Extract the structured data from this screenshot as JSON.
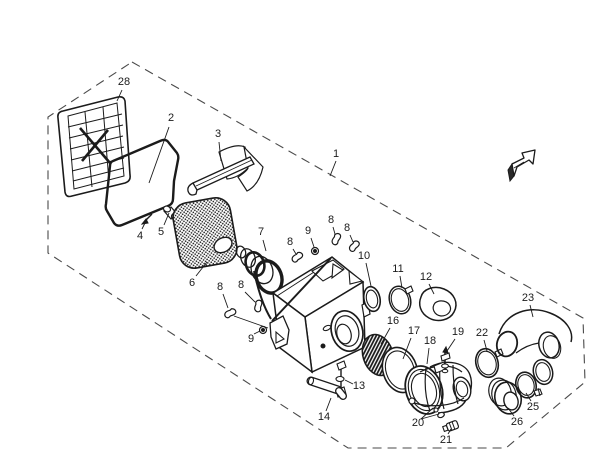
{
  "canvas": {
    "width": 605,
    "height": 471,
    "background": "#ffffff",
    "line_color": "#1b1b1b"
  },
  "diagram": {
    "type": "exploded-parts-diagram",
    "part_numbers_shown": [
      "1",
      "2",
      "3",
      "4",
      "5",
      "6",
      "7",
      "8",
      "9",
      "10",
      "11",
      "12",
      "13",
      "14",
      "16",
      "17",
      "18",
      "19",
      "20",
      "21",
      "22",
      "23",
      "25",
      "26",
      "28"
    ]
  },
  "icons": {
    "direction_arrow": "3d-arrow-up-right-icon"
  },
  "callouts": [
    {
      "n": "28",
      "x": 124,
      "y": 82,
      "leaders": [
        [
          122,
          90,
          117,
          101
        ]
      ]
    },
    {
      "n": "2",
      "x": 171,
      "y": 118,
      "leaders": [
        [
          169,
          127,
          149,
          183
        ]
      ]
    },
    {
      "n": "3",
      "x": 218,
      "y": 134,
      "leaders": [
        [
          219,
          142,
          221,
          161
        ]
      ]
    },
    {
      "n": "1",
      "x": 336,
      "y": 154,
      "leaders": [
        [
          336,
          161,
          330,
          176
        ]
      ]
    },
    {
      "n": "4",
      "x": 140,
      "y": 236,
      "leaders": [
        [
          142,
          229,
          147,
          219
        ]
      ]
    },
    {
      "n": "5",
      "x": 161,
      "y": 232,
      "leaders": [
        [
          164,
          225,
          169,
          213
        ]
      ]
    },
    {
      "n": "6",
      "x": 192,
      "y": 283,
      "leaders": [
        [
          196,
          276,
          207,
          262
        ]
      ]
    },
    {
      "n": "7",
      "x": 261,
      "y": 232,
      "leaders": [
        [
          263,
          240,
          266,
          251
        ]
      ]
    },
    {
      "n": "8",
      "x": 290,
      "y": 242,
      "leaders": [
        [
          293,
          249,
          296,
          254
        ]
      ]
    },
    {
      "n": "9",
      "x": 308,
      "y": 231,
      "leaders": [
        [
          311,
          238,
          314,
          247
        ]
      ]
    },
    {
      "n": "8",
      "x": 331,
      "y": 220,
      "leaders": [
        [
          333,
          227,
          335,
          234
        ]
      ]
    },
    {
      "n": "8",
      "x": 347,
      "y": 228,
      "leaders": [
        [
          350,
          235,
          353,
          242
        ]
      ]
    },
    {
      "n": "8",
      "x": 220,
      "y": 287,
      "leaders": [
        [
          223,
          294,
          228,
          308
        ]
      ]
    },
    {
      "n": "8",
      "x": 241,
      "y": 285,
      "leaders": [
        [
          245,
          292,
          255,
          302
        ]
      ]
    },
    {
      "n": "9",
      "x": 251,
      "y": 339,
      "leaders": [
        [
          254,
          334,
          260,
          331
        ]
      ]
    },
    {
      "n": "10",
      "x": 364,
      "y": 256,
      "leaders": [
        [
          366,
          263,
          371,
          286
        ]
      ]
    },
    {
      "n": "11",
      "x": 398,
      "y": 269,
      "leaders": [
        [
          400,
          276,
          402,
          288
        ]
      ]
    },
    {
      "n": "12",
      "x": 426,
      "y": 277,
      "leaders": [
        [
          429,
          284,
          434,
          294
        ]
      ]
    },
    {
      "n": "13",
      "x": 359,
      "y": 386,
      "leaders": [
        [
          353,
          384,
          345,
          380
        ]
      ]
    },
    {
      "n": "14",
      "x": 324,
      "y": 417,
      "leaders": [
        [
          326,
          411,
          331,
          398
        ]
      ]
    },
    {
      "n": "16",
      "x": 393,
      "y": 321,
      "leaders": [
        [
          390,
          328,
          381,
          344
        ]
      ]
    },
    {
      "n": "17",
      "x": 414,
      "y": 331,
      "leaders": [
        [
          411,
          338,
          403,
          359
        ]
      ]
    },
    {
      "n": "18",
      "x": 430,
      "y": 341,
      "leaders": [
        [
          429,
          348,
          427,
          364
        ]
      ]
    },
    {
      "n": "19",
      "x": 458,
      "y": 332,
      "leaders": [
        [
          455,
          339,
          447,
          351
        ]
      ]
    },
    {
      "n": "20",
      "x": 418,
      "y": 423,
      "leaders": [
        [
          421,
          419,
          433,
          408
        ],
        [
          421,
          419,
          439,
          414
        ]
      ]
    },
    {
      "n": "21",
      "x": 446,
      "y": 440,
      "leaders": [
        [
          448,
          434,
          451,
          429
        ]
      ]
    },
    {
      "n": "22",
      "x": 482,
      "y": 333,
      "leaders": [
        [
          484,
          340,
          487,
          351
        ]
      ]
    },
    {
      "n": "23",
      "x": 528,
      "y": 298,
      "leaders": [
        [
          530,
          305,
          533,
          317
        ]
      ]
    },
    {
      "n": "25",
      "x": 533,
      "y": 407,
      "leaders": [
        [
          531,
          401,
          526,
          393
        ]
      ]
    },
    {
      "n": "26",
      "x": 517,
      "y": 422,
      "leaders": [
        [
          514,
          416,
          508,
          408
        ]
      ]
    }
  ]
}
